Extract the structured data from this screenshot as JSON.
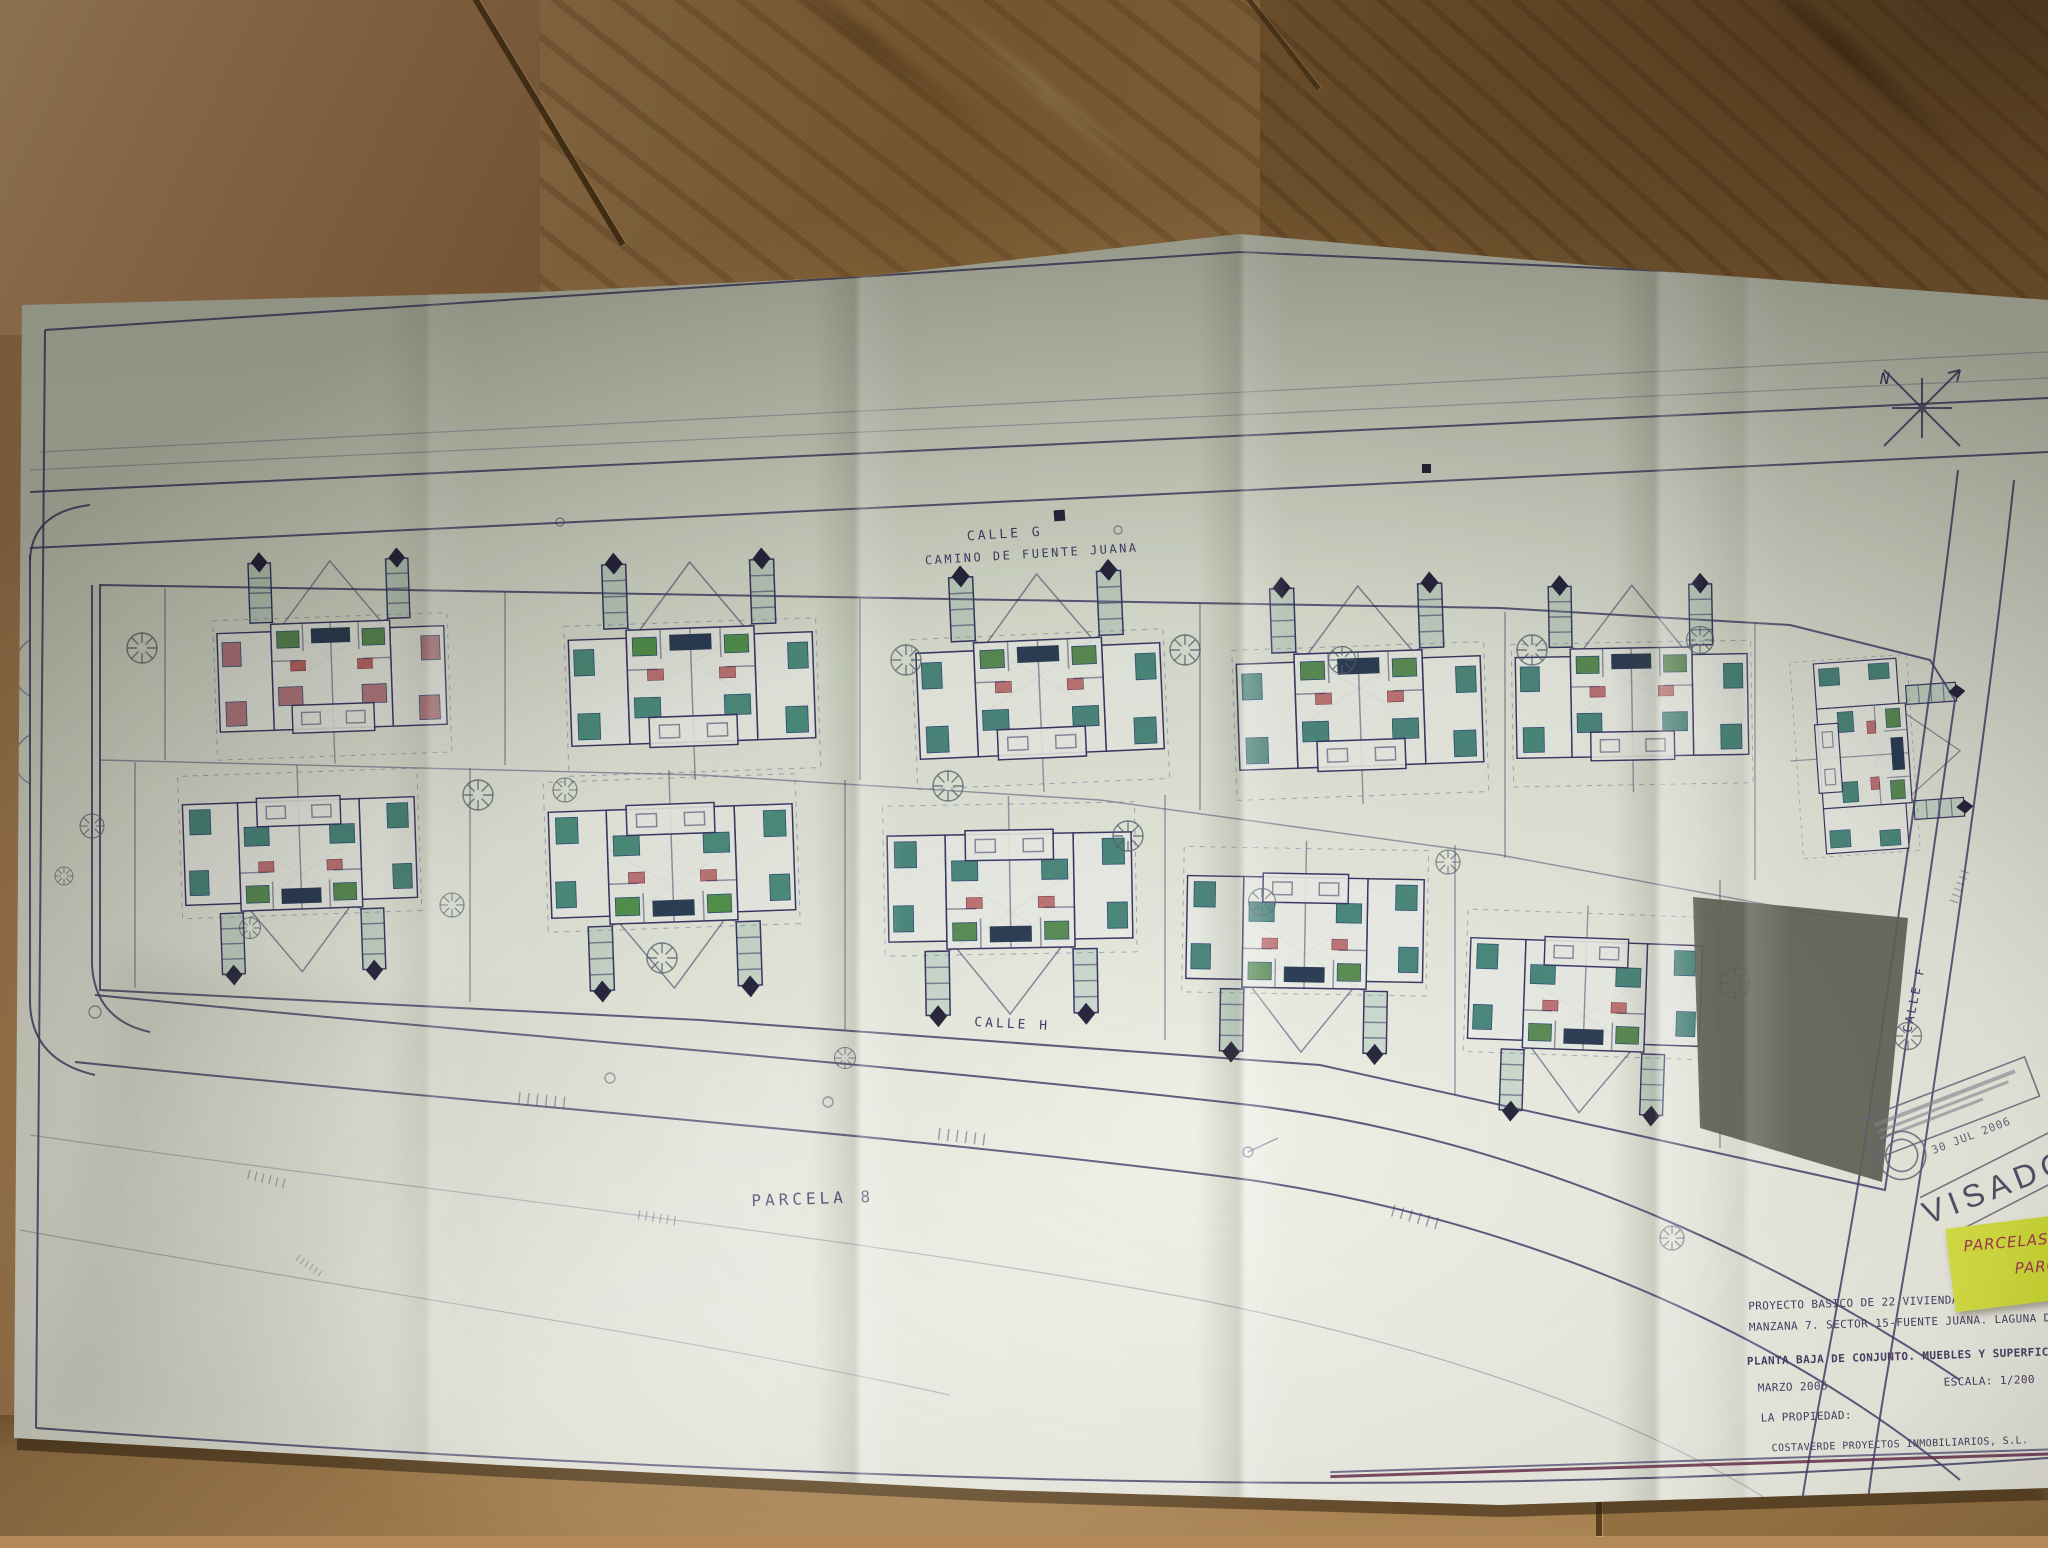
{
  "plan": {
    "streets": {
      "top_name": "CALLE G",
      "top_subtitle": "CAMINO DE FUENTE JUANA",
      "bottom_name": "CALLE H",
      "left_name": "CALLE C",
      "right_name": "CALLE F"
    },
    "parcel_label": "PARCELA 8",
    "north_label": "N",
    "stamp": {
      "visado_text": "VISADO",
      "date_text": "30 JUL 2006"
    },
    "sticky_note": {
      "line1": "PARCELAS",
      "line2": "PARC"
    },
    "title_block": {
      "line1": "PROYECTO BASICO DE 22 VIVIENDAS PAREADAS EN PARCE",
      "line2": "MANZANA 7. SECTOR 15-FUENTE JUANA. LAGUNA DE DUE",
      "line3": "PLANTA BAJA DE CONJUNTO. MUEBLES Y SUPERFICIES",
      "date": "MARZO 2006",
      "scale": "ESCALA: 1/200",
      "owner_label": "LA PROPIEDAD:",
      "owner_name": "COSTAVERDE PROYECTOS INMOBILIARIOS, S.L."
    },
    "colors": {
      "ink": "#46426f",
      "teal": "#4e8b80",
      "sticky": "#d8e544",
      "paper": "#e4e9dc",
      "floor": "#b3895a",
      "building_fill": "#64655a"
    }
  }
}
